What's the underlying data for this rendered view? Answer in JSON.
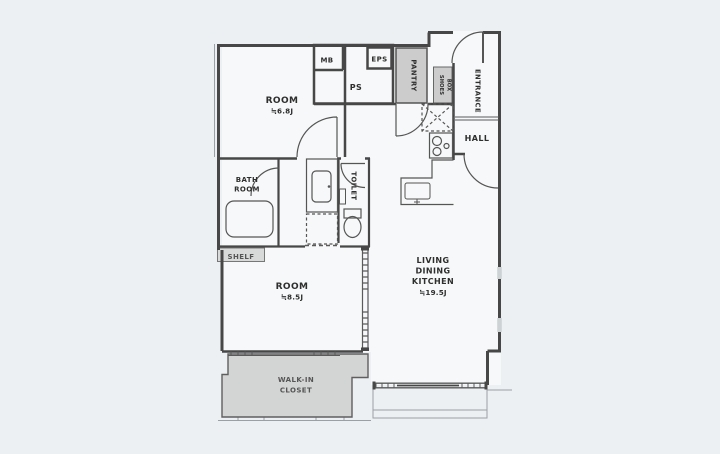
{
  "floor_plan": {
    "rooms": {
      "room_top": {
        "name": "ROOM",
        "area": "≒6.8J"
      },
      "room_bottom": {
        "name": "ROOM",
        "area": "≒8.5J"
      },
      "ldk": {
        "line1": "LIVING",
        "line2": "DINING",
        "line3": "KITCHEN",
        "area": "≒19.5J"
      },
      "bathroom": {
        "line1": "BATH",
        "line2": "ROOM"
      },
      "dressing_room": {
        "name": "DRESSING ROOM"
      },
      "toilet": {
        "name": "TOILET"
      },
      "hall": {
        "name": "HALL"
      },
      "entrance": {
        "name": "ENTRANCE"
      },
      "pantry": {
        "name": "PANTRY"
      },
      "shoes_box": {
        "line1": "SHOES",
        "line2": "BOX"
      },
      "shelf": {
        "name": "SHELF"
      },
      "walk_in_closet": {
        "line1": "WALK-IN",
        "line2": "CLOSET"
      },
      "mb": {
        "name": "MB"
      },
      "eps": {
        "name": "EPS"
      },
      "ps": {
        "name": "PS"
      }
    },
    "colors": {
      "background": "#edf0f2",
      "floor": "#f7f8f9",
      "wall": "#474747",
      "service_fill": "#d2d4d3",
      "label": "#2e2e2e"
    }
  }
}
